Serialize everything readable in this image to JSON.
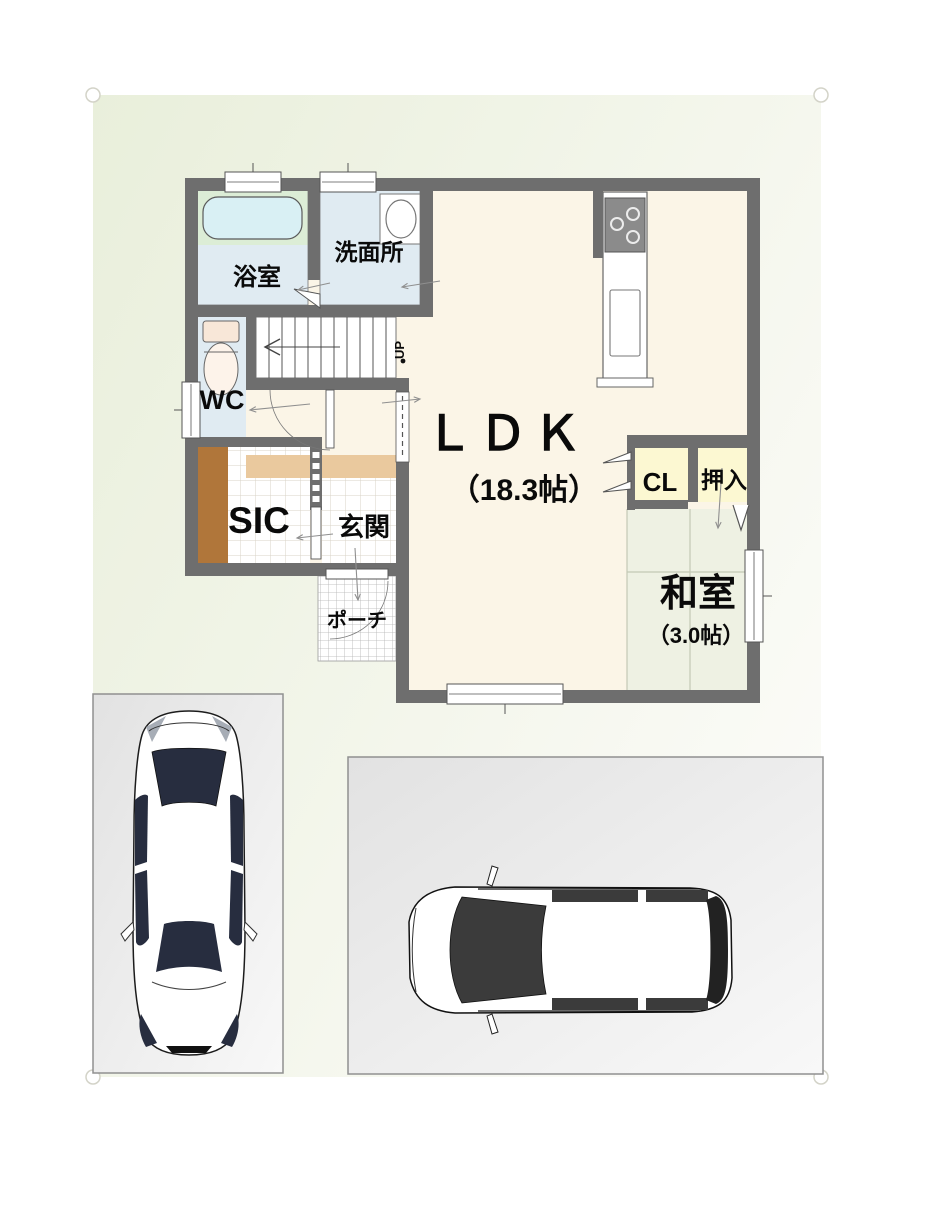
{
  "floor_plan": {
    "rooms": {
      "bath": {
        "label": "浴室"
      },
      "washroom": {
        "label": "洗面所"
      },
      "wc": {
        "label": "WC"
      },
      "sic": {
        "label": "SIC"
      },
      "genkan": {
        "label": "玄関"
      },
      "porch": {
        "label": "ポーチ"
      },
      "ldk": {
        "label": "ＬＤＫ",
        "size": "（18.3帖）"
      },
      "closet": {
        "label": "CL"
      },
      "oshiire": {
        "label": "押入"
      },
      "washitsu": {
        "label": "和室",
        "size": "（3.0帖）"
      }
    },
    "stairs": {
      "label": "UP"
    },
    "colors": {
      "wall": "#6e6e6e",
      "outline": "#555555",
      "floor_cream": "#fbf5e7",
      "bath_counter": "#dcedd6",
      "bathtub": "#d9f0f4",
      "wet_floor": "#e0ebf2",
      "tile_line": "#d9d3c7",
      "wood_brown": "#b0763a",
      "step_tan": "#eac99e",
      "closet_yellow": "#fcf8d2",
      "tatami": "#eef1e3",
      "tatami_line": "#c3c9b5",
      "lot_green": "#e9efdb",
      "lot_white": "#fbfbf7",
      "paving": "#e2e2e2",
      "paving_light": "#f8f8f8",
      "car_glass": "#272d3f",
      "van_glass": "#3b3b3b"
    }
  },
  "parking": {
    "left_space": {
      "vehicle": "sedan-top-view"
    },
    "right_space": {
      "vehicle": "minivan-top-view"
    }
  }
}
